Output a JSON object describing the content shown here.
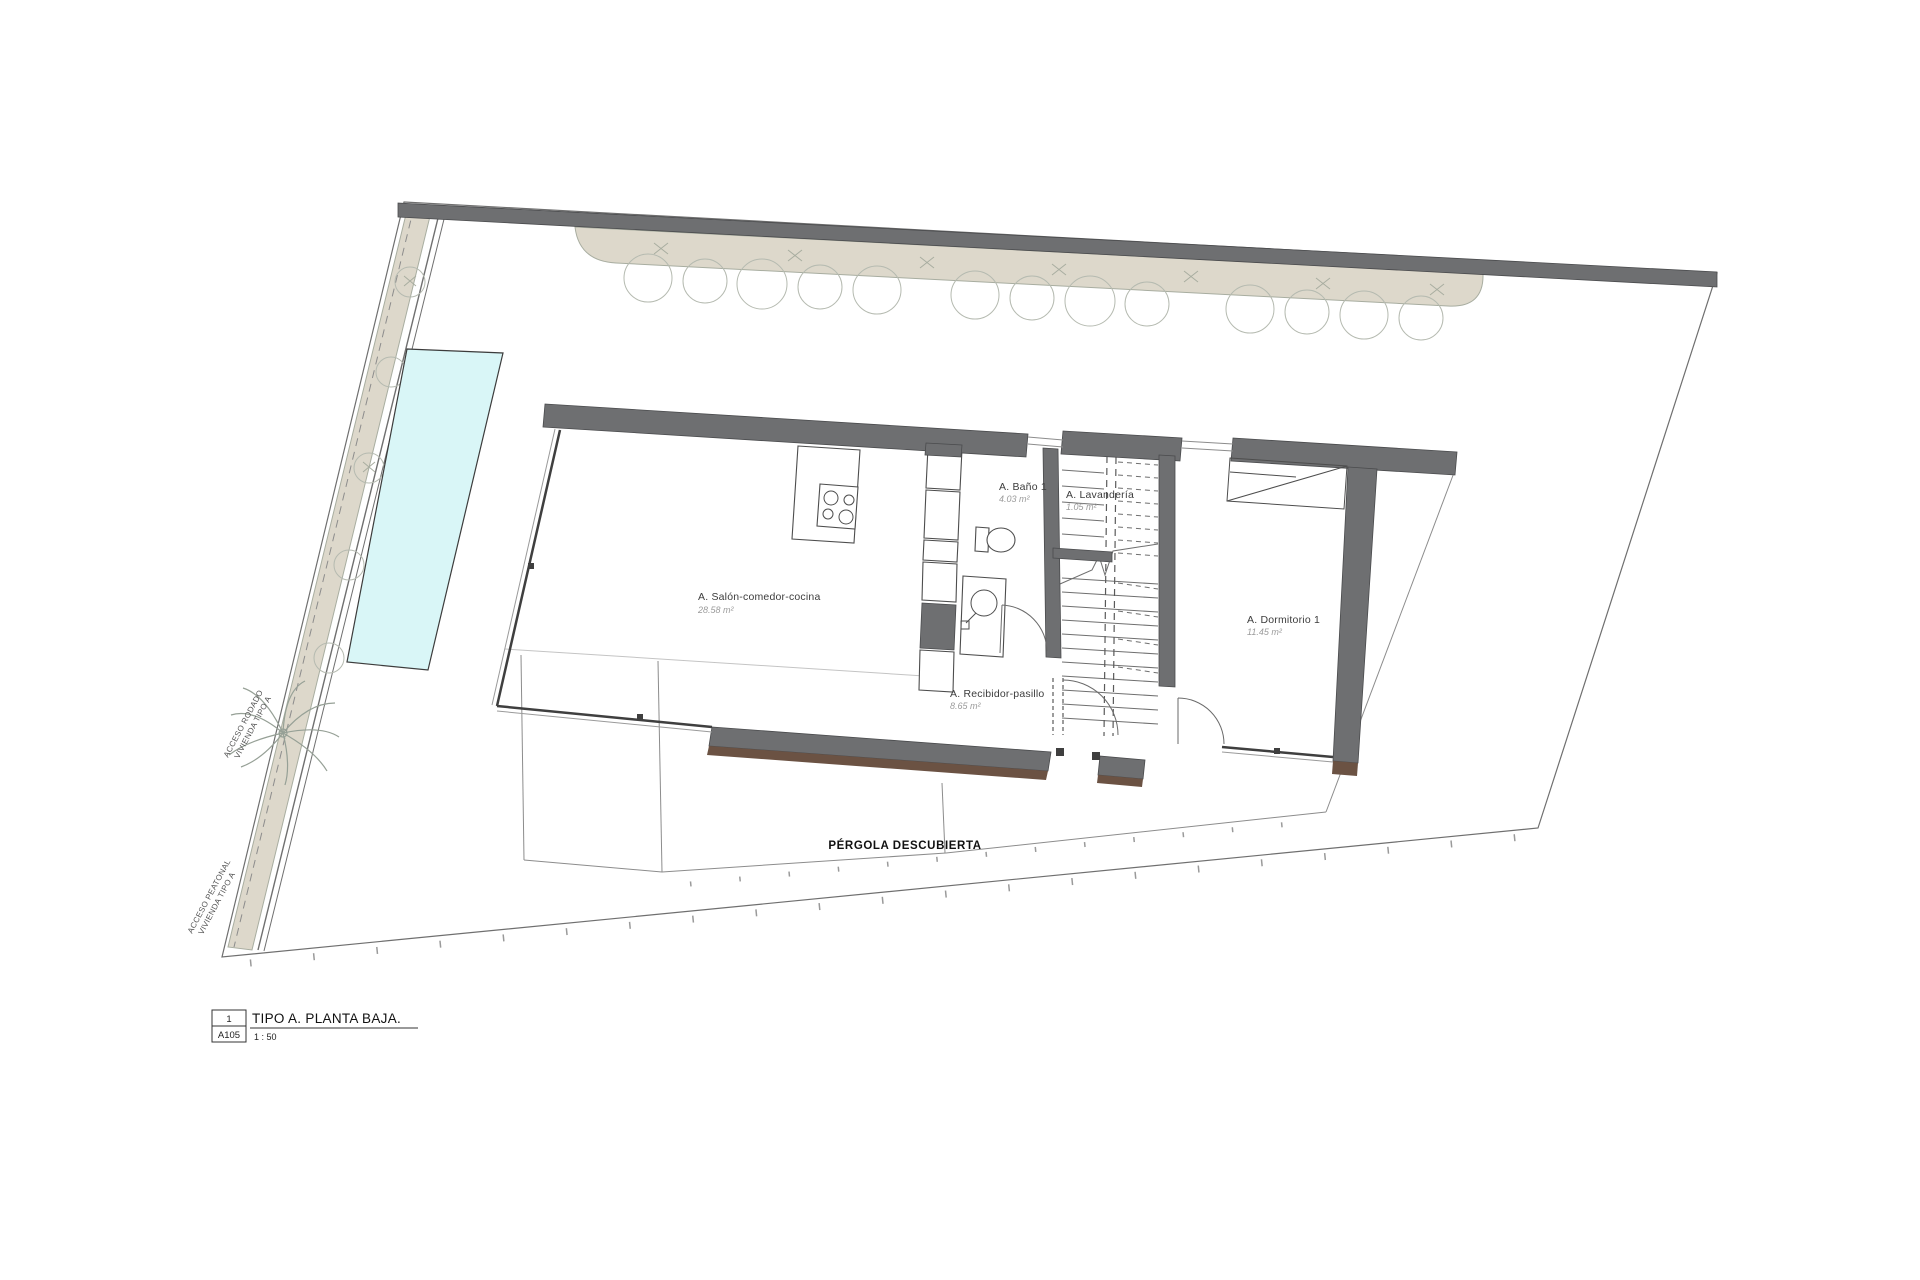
{
  "title_block": {
    "number": "1",
    "sheet": "A105",
    "title": "TIPO A. PLANTA BAJA.",
    "scale": "1 : 50"
  },
  "site": {
    "pergola_label": "PÉRGOLA DESCUBIERTA",
    "access_road_line1": "ACCESO RODADO",
    "access_road_line2": "VIVIENDA TIPO A",
    "access_ped_line1": "ACCESO PEATONAL",
    "access_ped_line2": "VIVIENDA TIPO A"
  },
  "rooms": [
    {
      "name": "A. Salón-comedor-cocina",
      "area": "28.58 m²"
    },
    {
      "name": "A. Baño 1",
      "area": "4.03 m²"
    },
    {
      "name": "A. Lavandería",
      "area": "1.05 m²"
    },
    {
      "name": "A. Recibidor-pasillo",
      "area": "8.65 m²"
    },
    {
      "name": "A. Dormitorio 1",
      "area": "11.45 m²"
    }
  ],
  "colors": {
    "wall": "#6e6f71",
    "wood": "#6b5243",
    "vegetation": "#ddd8cb",
    "pool": "#d9f6f7"
  }
}
